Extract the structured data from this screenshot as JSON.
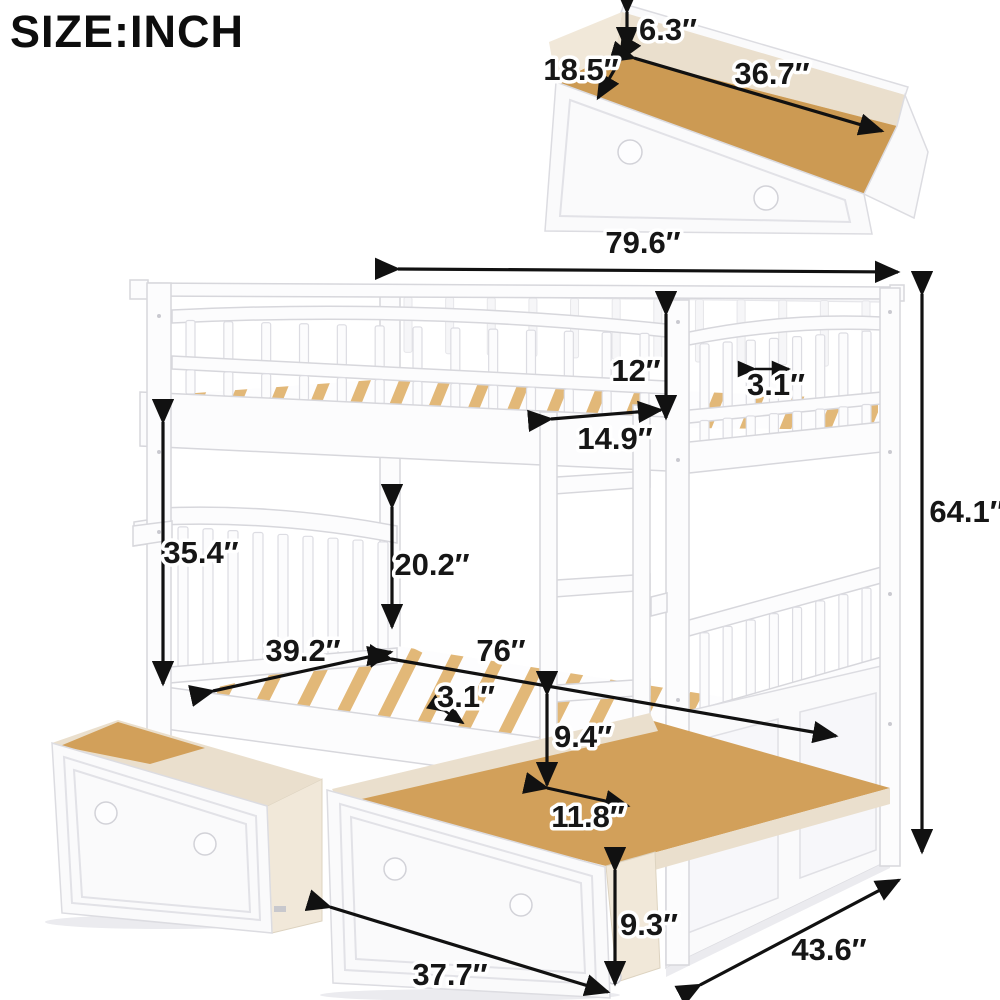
{
  "page": {
    "title": "SIZE:INCH"
  },
  "drawer_detail": {
    "height": "6.3″",
    "depth": "18.5″",
    "length": "36.7″"
  },
  "bed": {
    "overall_length": "79.6″",
    "guardrail_height": "12″",
    "slat_gap_upper": "3.1″",
    "upper_end_rail_width": "14.9″",
    "upper_section_height": "35.4″",
    "lower_guardrail_height": "20.2″",
    "headboard_width": "39.2″",
    "sleeping_length": "76″",
    "slat_gap_lower": "3.1″",
    "under_bed_clearance": "9.4″",
    "ladder_width": "11.8″",
    "overall_height": "64.1″",
    "drawer_front_height": "9.3″",
    "drawer_front_width": "37.7″",
    "overall_depth": "43.6″"
  }
}
